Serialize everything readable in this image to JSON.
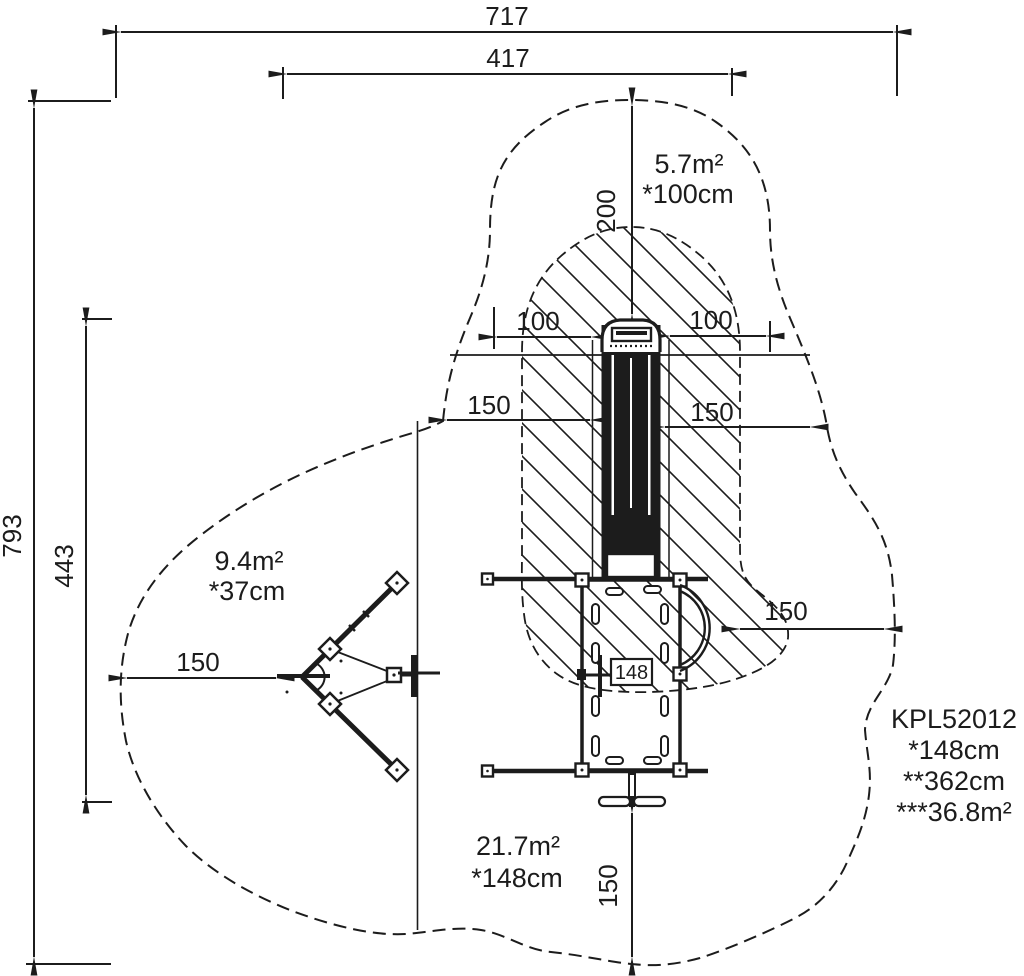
{
  "drawing": {
    "product": {
      "code": "KPL52012",
      "spec1": "*148cm",
      "spec2": "**362cm",
      "spec3": "***36.8m²"
    },
    "zones": {
      "top": {
        "area": "5.7m²",
        "height": "*100cm"
      },
      "left": {
        "area": "9.4m²",
        "height": "*37cm"
      },
      "bottom": {
        "area": "21.7m²",
        "height": "*148cm"
      }
    },
    "dims": {
      "total_width": "717",
      "inner_width": "417",
      "total_height": "793",
      "inner_height": "443",
      "runout_length": "200",
      "slide_half_left": "100",
      "slide_half_right": "100",
      "clear_left_mid": "150",
      "clear_right_mid": "150",
      "clear_left": "150",
      "clear_right_low": "150",
      "clear_bottom": "150",
      "platform_size": "148"
    },
    "colors": {
      "ink": "#1c1c1c",
      "background": "#ffffff"
    }
  }
}
